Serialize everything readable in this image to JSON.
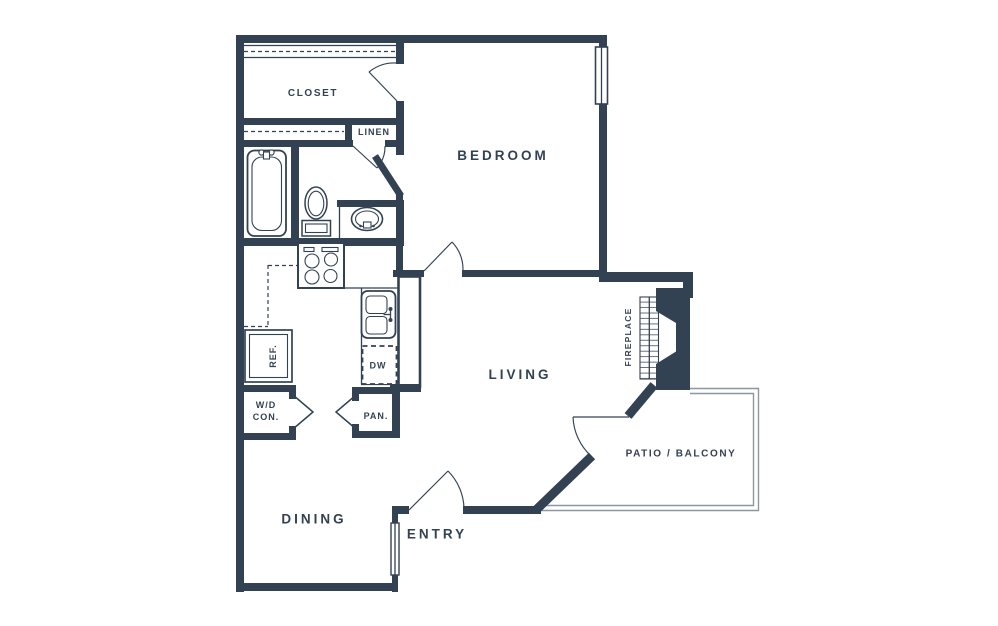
{
  "colors": {
    "wall": "#334253",
    "railing": "#8d96a3",
    "background": "#ffffff"
  },
  "rooms": {
    "closet": "CLOSET",
    "linen": "LINEN",
    "bedroom": "BEDROOM",
    "living": "LIVING",
    "dining": "DINING",
    "entry": "ENTRY",
    "patio_balcony": "PATIO / BALCONY",
    "fireplace": "FIREPLACE"
  },
  "fixtures": {
    "refrigerator": "REF.",
    "dishwasher": "DW",
    "pantry": "PAN.",
    "washer_dryer": {
      "line1": "W/D",
      "line2": "CON."
    }
  }
}
